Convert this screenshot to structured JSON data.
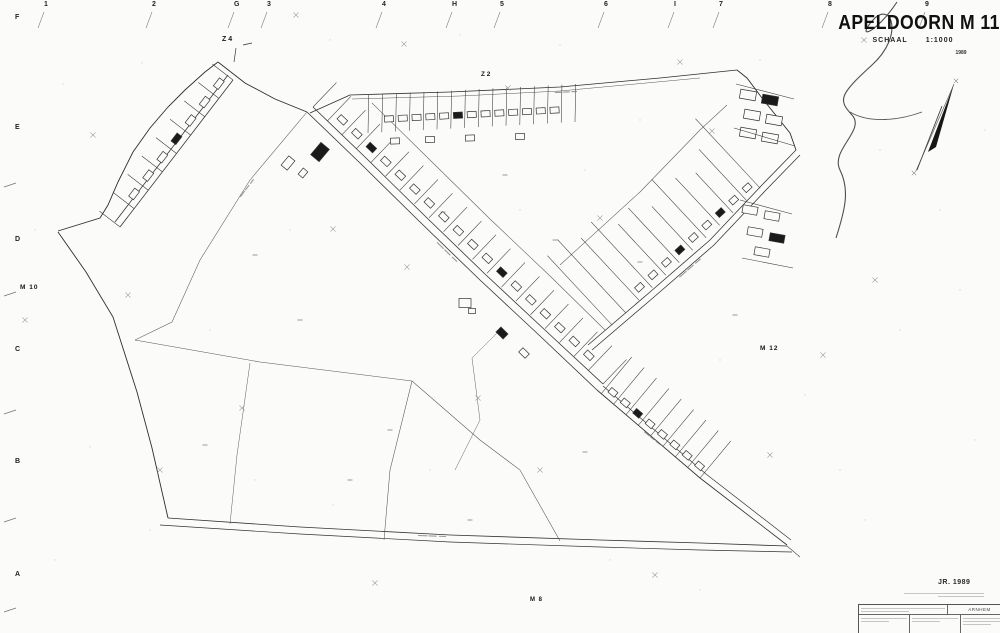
{
  "sheet": {
    "title": "APELDOORN M 11",
    "scale_label": "SCHAAL",
    "scale_value": "1:1000",
    "edition_year": "1989",
    "journal": "JR. 1989"
  },
  "adjacent_sheets": {
    "top_left": "Z 4",
    "top": "Z 2",
    "left": "M 10",
    "right": "M 12",
    "bottom": "M 8"
  },
  "grid": {
    "top": [
      {
        "label": "1",
        "x": 47
      },
      {
        "label": "2",
        "x": 155
      },
      {
        "label": "G",
        "x": 237
      },
      {
        "label": "3",
        "x": 270
      },
      {
        "label": "4",
        "x": 385
      },
      {
        "label": "H",
        "x": 455
      },
      {
        "label": "5",
        "x": 503
      },
      {
        "label": "6",
        "x": 607
      },
      {
        "label": "I",
        "x": 677
      },
      {
        "label": "7",
        "x": 722
      },
      {
        "label": "8",
        "x": 831
      },
      {
        "label": "9",
        "x": 928
      }
    ],
    "left": [
      {
        "label": "F",
        "y": 14
      },
      {
        "label": "E",
        "y": 124
      },
      {
        "label": "D",
        "y": 236
      },
      {
        "label": "C",
        "y": 346
      },
      {
        "label": "B",
        "y": 458
      },
      {
        "label": "A",
        "y": 571
      }
    ]
  },
  "stamp": {
    "office": "ARNHEM"
  }
}
